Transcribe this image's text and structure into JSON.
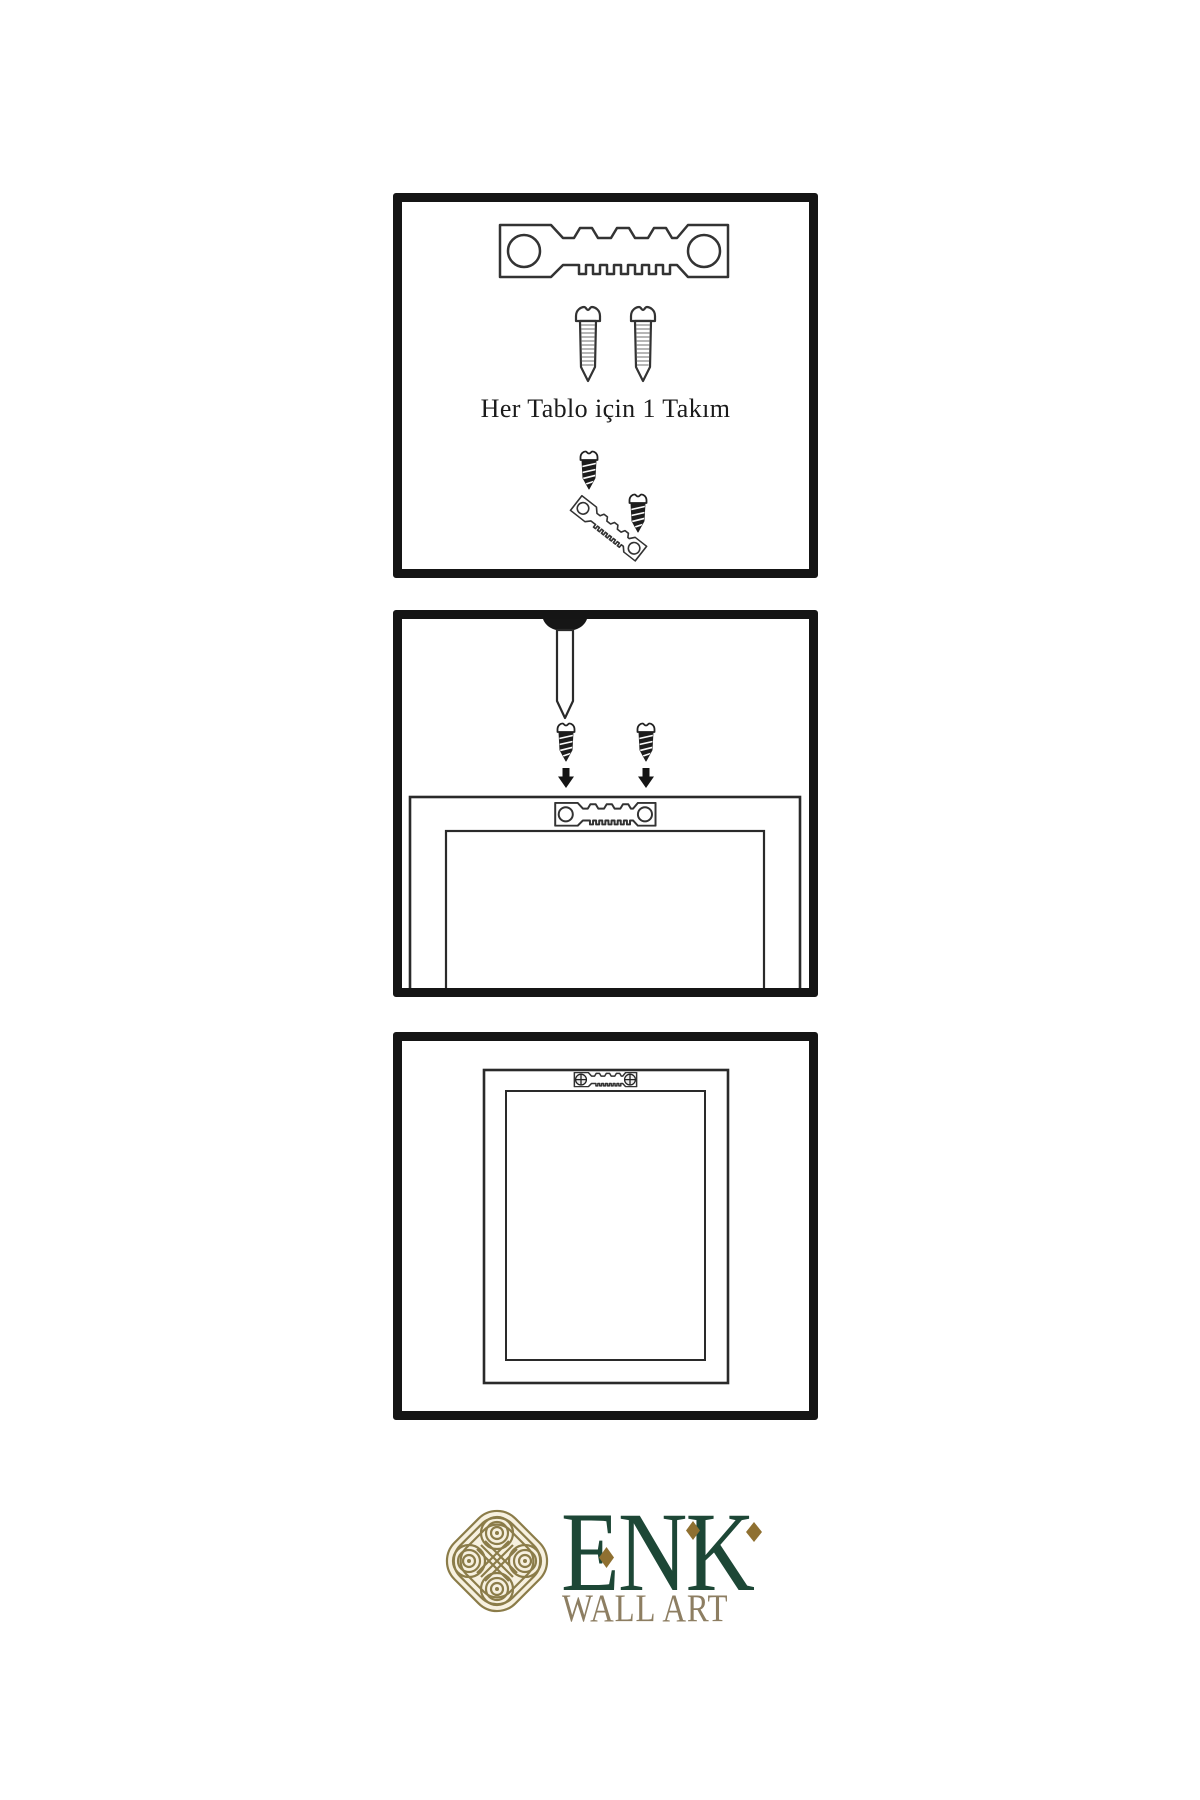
{
  "page": {
    "background_color": "#ffffff"
  },
  "instructions": {
    "border_color": "#151515",
    "panels": [
      {
        "name": "kit-contents",
        "caption": "Her Tablo için 1 Takım",
        "icons": [
          "sawtooth-hanger",
          "screw",
          "screw",
          "screw-into-tilted-hanger-demo"
        ]
      },
      {
        "name": "attach-hanger-step",
        "icons": [
          "wall-nail",
          "screw-with-down-arrow",
          "screw-with-down-arrow",
          "frame-back-with-sawtooth-hanger"
        ]
      },
      {
        "name": "mounted-frame-step",
        "icons": [
          "frame-back-with-screwed-hanger"
        ]
      }
    ]
  },
  "logo": {
    "brand": "ENK",
    "subtitle": "WALL ART",
    "colors": {
      "brand_green": "#1d4736",
      "knot_gold": "#8b7c49",
      "subtitle_tan": "#8d7e62",
      "diamond_gold": "#8f7031"
    }
  }
}
